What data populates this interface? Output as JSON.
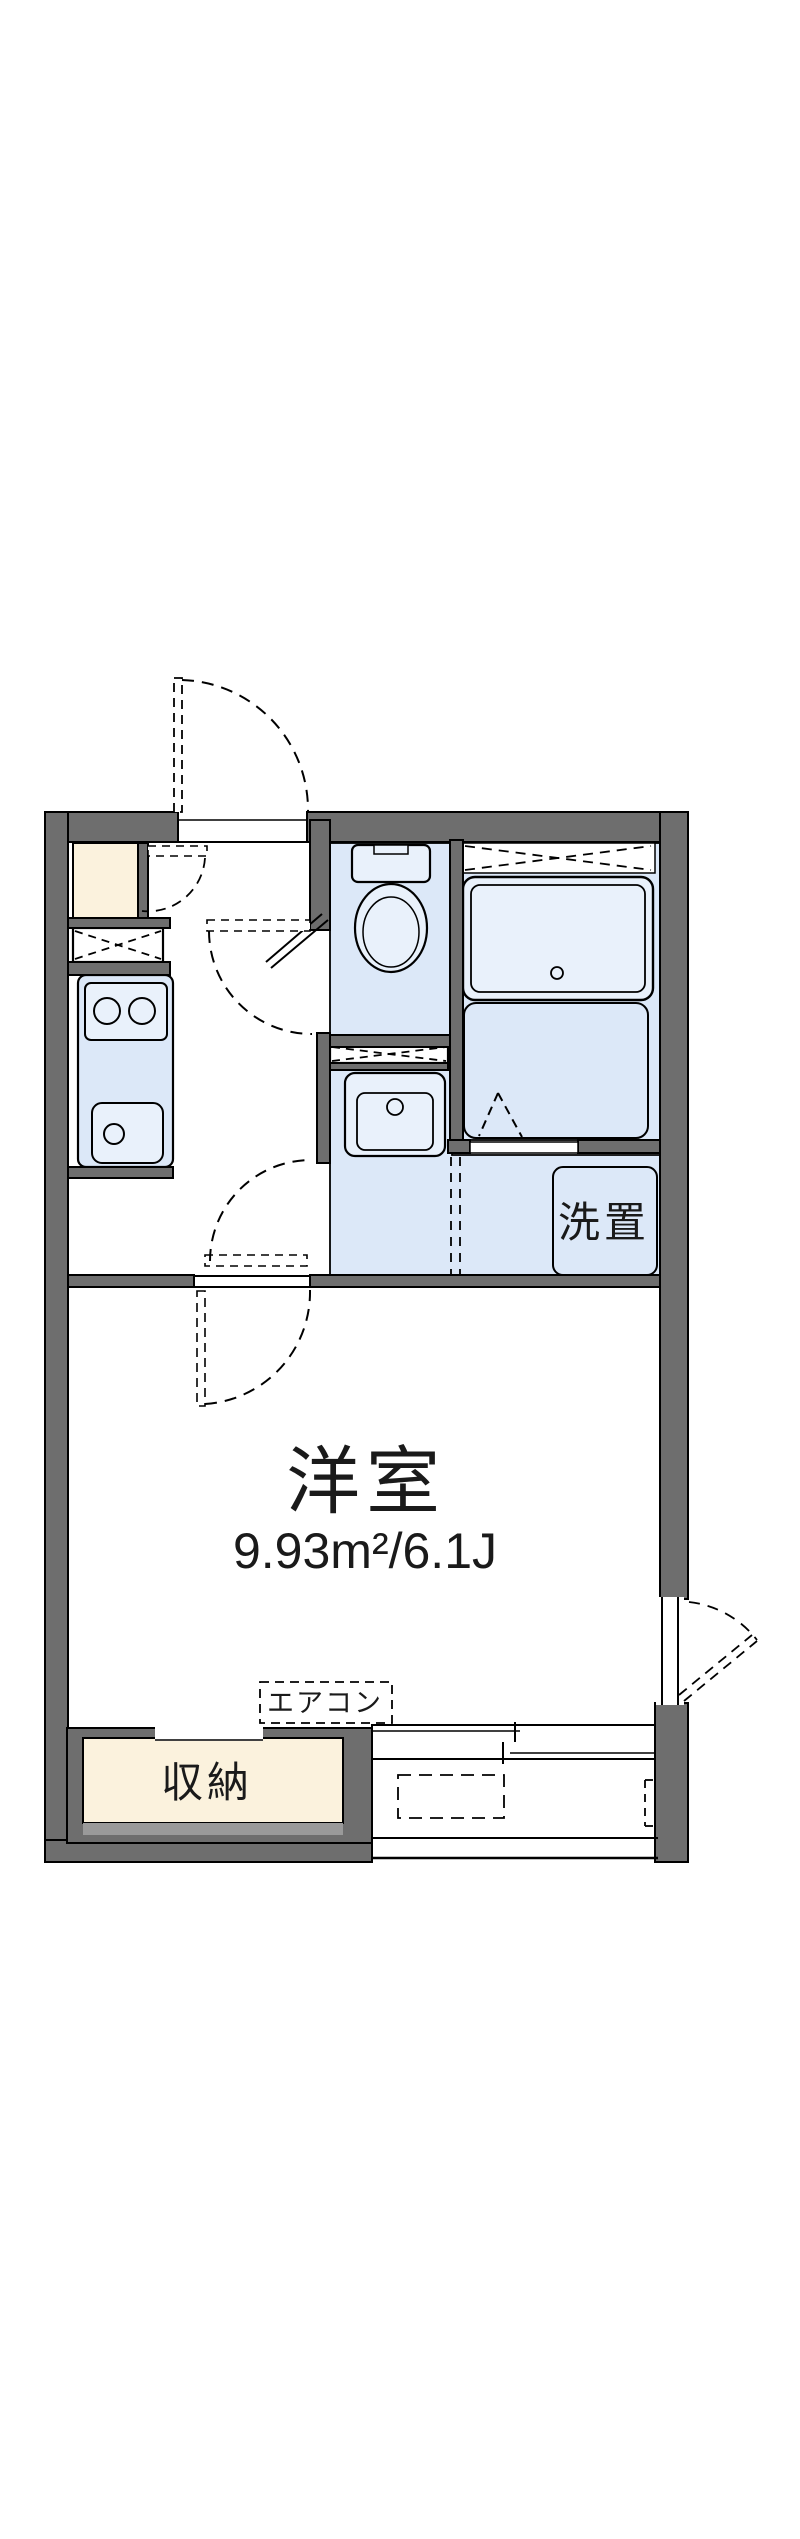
{
  "floorplan": {
    "labels": {
      "main_room_name": "洋室",
      "main_room_area": "9.93m²/6.1J",
      "storage": "収納",
      "air_conditioner": "エアコン",
      "laundry": "洗置"
    },
    "colors": {
      "wall_gray": "#6e6e6e",
      "room_blue": "#dce8f8",
      "fixture_fill": "#e9f1fb",
      "storage_cream": "#fbf2dd",
      "shelf_gray": "#9a9a9a",
      "outline_black": "#000000",
      "background": "#ffffff"
    }
  }
}
